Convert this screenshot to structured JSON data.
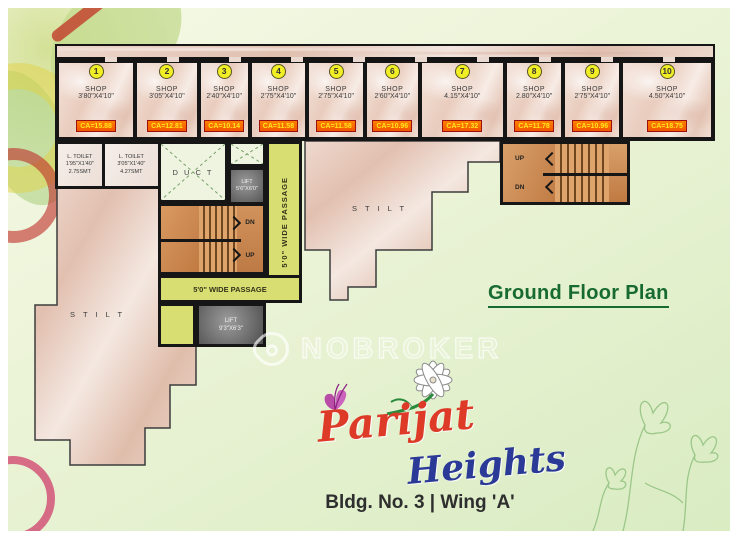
{
  "titles": {
    "plan_title": "Ground Floor Plan",
    "building_line": "Bldg. No. 3 | Wing 'A'"
  },
  "watermark": {
    "brand": "NOBROKER"
  },
  "logo": {
    "primary": "Parijat",
    "secondary": "Heights"
  },
  "colors": {
    "ca_badge_bg": "#f25600",
    "ca_badge_text": "#ffe81a",
    "shop_number_bg": "#f2ee25",
    "passage_yellow": "#d9de72",
    "plan_title": "#186b30",
    "logo_primary": "#dd3a28",
    "logo_secondary": "#2a3a96"
  },
  "shops": [
    {
      "no": "1",
      "label": "SHOP",
      "dim": "3'80\"X4'10\"",
      "ca": "CA=15.88",
      "w": 3.8
    },
    {
      "no": "2",
      "label": "SHOP",
      "dim": "3'05\"X4'10\"",
      "ca": "CA=12.81",
      "w": 3.05
    },
    {
      "no": "3",
      "label": "SHOP",
      "dim": "2'40\"X4'10\"",
      "ca": "CA=10.14",
      "w": 2.4
    },
    {
      "no": "4",
      "label": "SHOP",
      "dim": "2'75\"X4'10\"",
      "ca": "CA=11.58",
      "w": 2.75
    },
    {
      "no": "5",
      "label": "SHOP",
      "dim": "2'75\"X4'10\"",
      "ca": "CA=11.58",
      "w": 2.75
    },
    {
      "no": "6",
      "label": "SHOP",
      "dim": "2'60\"X4'10\"",
      "ca": "CA=10.96",
      "w": 2.6
    },
    {
      "no": "7",
      "label": "SHOP",
      "dim": "4.15\"X4'10\"",
      "ca": "CA=17.32",
      "w": 4.15
    },
    {
      "no": "8",
      "label": "SHOP",
      "dim": "2.80\"X4'10\"",
      "ca": "CA=11.78",
      "w": 2.8
    },
    {
      "no": "9",
      "label": "SHOP",
      "dim": "2'75\"X4'10\"",
      "ca": "CA=10.96",
      "w": 2.75
    },
    {
      "no": "10",
      "label": "SHOP",
      "dim": "4.50\"X4'10\"",
      "ca": "CA=18.75",
      "w": 4.5
    }
  ],
  "toilets": [
    {
      "label": "L. TOILET",
      "dim": "1'95\"X1'40\"",
      "area": "2.75SMT"
    },
    {
      "label": "L. TOILET",
      "dim": "3'05\"X1'40\"",
      "area": "4.27SMT"
    }
  ],
  "rooms": {
    "duct": "D U C T",
    "stilt_left": "S T I L T",
    "stilt_middle": "S T I L T",
    "passage_vertical": "5'0\" WIDE PASSAGE",
    "passage_horizontal": "5'0\" WIDE PASSAGE",
    "lift_small": {
      "label": "LIFT",
      "dim": "5'6\"X6'0\""
    },
    "lift_large": {
      "label": "LIFT",
      "dim": "9'3\"X6'3\""
    },
    "stairs_middle": {
      "top": "DN",
      "bottom": "UP"
    },
    "stairs_right": {
      "top": "UP",
      "bottom": "DN"
    }
  }
}
